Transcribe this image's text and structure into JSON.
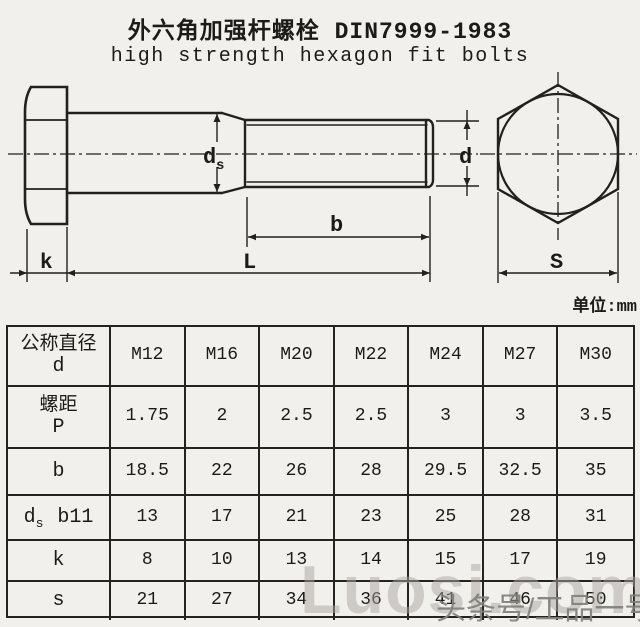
{
  "title": {
    "zh": "外六角加强杆螺栓 DIN7999-1983",
    "en": "high strength hexagon fit bolts"
  },
  "drawing": {
    "unit_note": "单位:mm",
    "labels": {
      "ds_main": "d",
      "ds_sub": "s",
      "d": "d",
      "b": "b",
      "l": "L",
      "k": "k",
      "s": "S"
    }
  },
  "table": {
    "rows": [
      {
        "label_lines": [
          "公称直径",
          "d"
        ],
        "values": [
          "M12",
          "M16",
          "M20",
          "M22",
          "M24",
          "M27",
          "M30"
        ]
      },
      {
        "label_lines": [
          "螺距",
          "P"
        ],
        "values": [
          "1.75",
          "2",
          "2.5",
          "2.5",
          "3",
          "3",
          "3.5"
        ]
      },
      {
        "label_lines": [
          "b"
        ],
        "values": [
          "18.5",
          "22",
          "26",
          "28",
          "29.5",
          "32.5",
          "35"
        ]
      },
      {
        "label_main": "d",
        "label_sub": "s",
        "label_suffix": "b11",
        "values": [
          "13",
          "17",
          "21",
          "23",
          "25",
          "28",
          "31"
        ]
      },
      {
        "label_lines": [
          "k"
        ],
        "values": [
          "8",
          "10",
          "13",
          "14",
          "15",
          "17",
          "19"
        ]
      },
      {
        "label_lines": [
          "s"
        ],
        "values": [
          "21",
          "27",
          "34",
          "36",
          "41",
          "46",
          "50"
        ]
      }
    ]
  },
  "watermarks": {
    "luosi": "Luosi.com",
    "toutiao": "头条号/工品一号"
  }
}
